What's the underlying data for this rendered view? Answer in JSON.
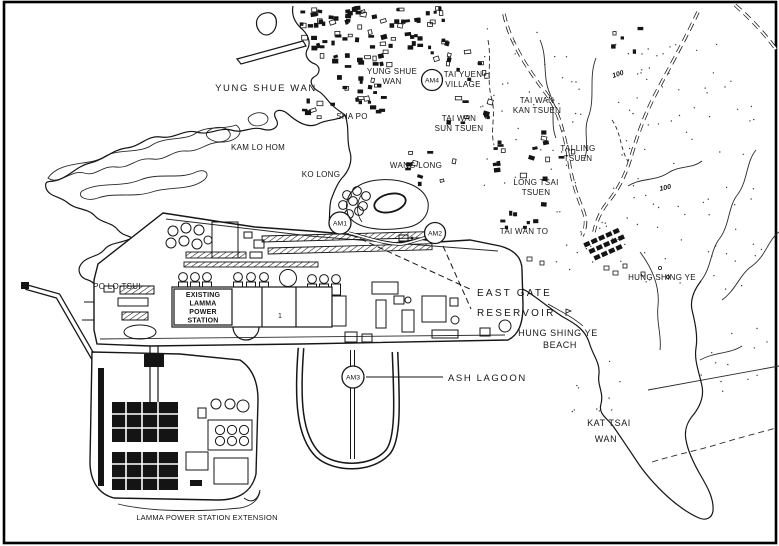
{
  "figure": {
    "type": "map",
    "subject": "Yung Shue Wan / Lamma Island site plan with air monitoring stations"
  },
  "place_labels": {
    "yung_shue_wan_bay": "YUNG SHUE WAN",
    "yung_shue_wan_village": {
      "line1": "YUNG SHUE",
      "line2": "WAN"
    },
    "tai_yuen_village": {
      "line1": "TAI YUEN",
      "line2": "VILLAGE"
    },
    "tai_wan_kan_tsuen": {
      "line1": "TAI WAN",
      "line2": "KAN TSUEN"
    },
    "sha_po": "SHA PO",
    "tai_wan_sun_tsuen": {
      "line1": "TAI WAN",
      "line2": "SUN TSUEN"
    },
    "kam_lo_hom": "KAM LO HOM",
    "tai_ling_tsuen": {
      "line1": "TAI LING",
      "line2": "TSUEN"
    },
    "ko_long": "KO LONG",
    "wang_long": "WANG LONG",
    "long_tsai_tsuen": {
      "line1": "LONG TSAI",
      "line2": "TSUEN"
    },
    "tai_wan_to": "TAI WAN TO",
    "hung_shing_ye": "HUNG SHING YE",
    "hung_shing_ye_beach": {
      "line1": "HUNG SHING YE",
      "line2": "BEACH"
    },
    "po_lo_tsui": "PO LO TSUI",
    "kat_tsai_wan": {
      "line1": "KAT TSAI",
      "line2": "WAN"
    }
  },
  "facilities": {
    "existing_station": {
      "line1": "EXISTING",
      "line2": "LAMMA",
      "line3": "POWER",
      "line4": "STATION"
    },
    "unit_marker": "1",
    "extension": "LAMMA POWER STATION EXTENSION"
  },
  "annotations": {
    "east_gate_reservoir": {
      "line1": "EAST GATE",
      "line2": "RESERVOIR"
    },
    "ash_lagoon": "ASH LAGOON"
  },
  "monitoring_stations": [
    {
      "id": "AM1"
    },
    {
      "id": "AM2"
    },
    {
      "id": "AM3"
    },
    {
      "id": "AM4"
    }
  ],
  "contours": {
    "label_a": "100",
    "label_b": "100"
  }
}
